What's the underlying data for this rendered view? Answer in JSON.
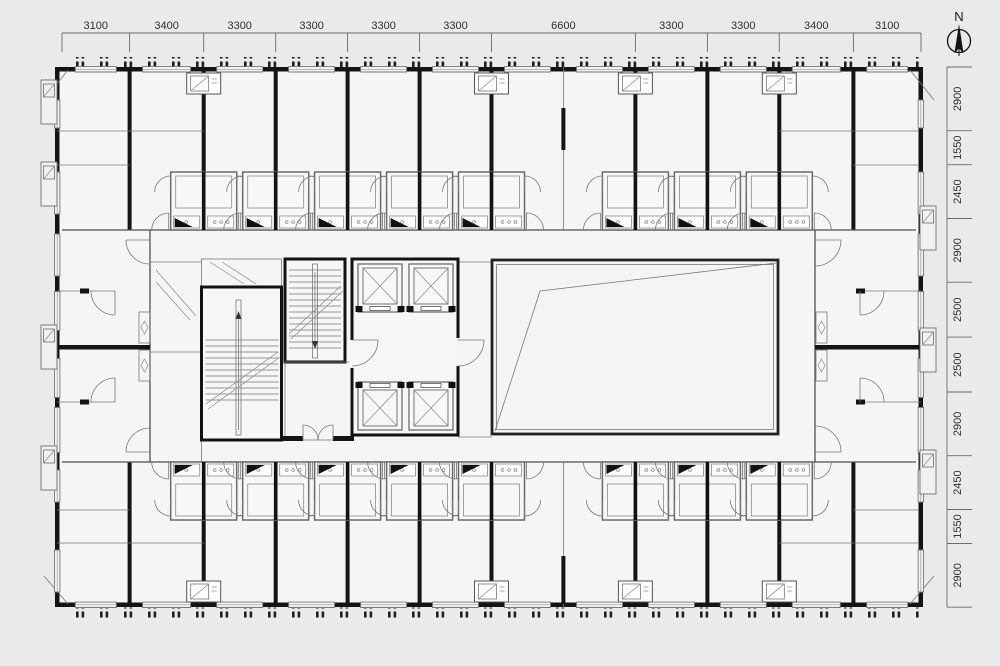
{
  "page": {
    "background": "#e9eaeb",
    "drawing_type": "architectural floor plan"
  },
  "compass": {
    "label": "N"
  },
  "dimensions": {
    "top": [
      "3100",
      "3400",
      "3300",
      "3300",
      "3300",
      "3300",
      "6600",
      "3300",
      "3300",
      "3400",
      "3100"
    ],
    "right": [
      "2900",
      "1550",
      "2450",
      "2900",
      "2500",
      "2500",
      "2900",
      "2450",
      "1550",
      "2900"
    ]
  },
  "colors": {
    "wall": "#141414",
    "line": "#555555",
    "background": "#e9eaeb",
    "paper": "#f5f5f5"
  }
}
